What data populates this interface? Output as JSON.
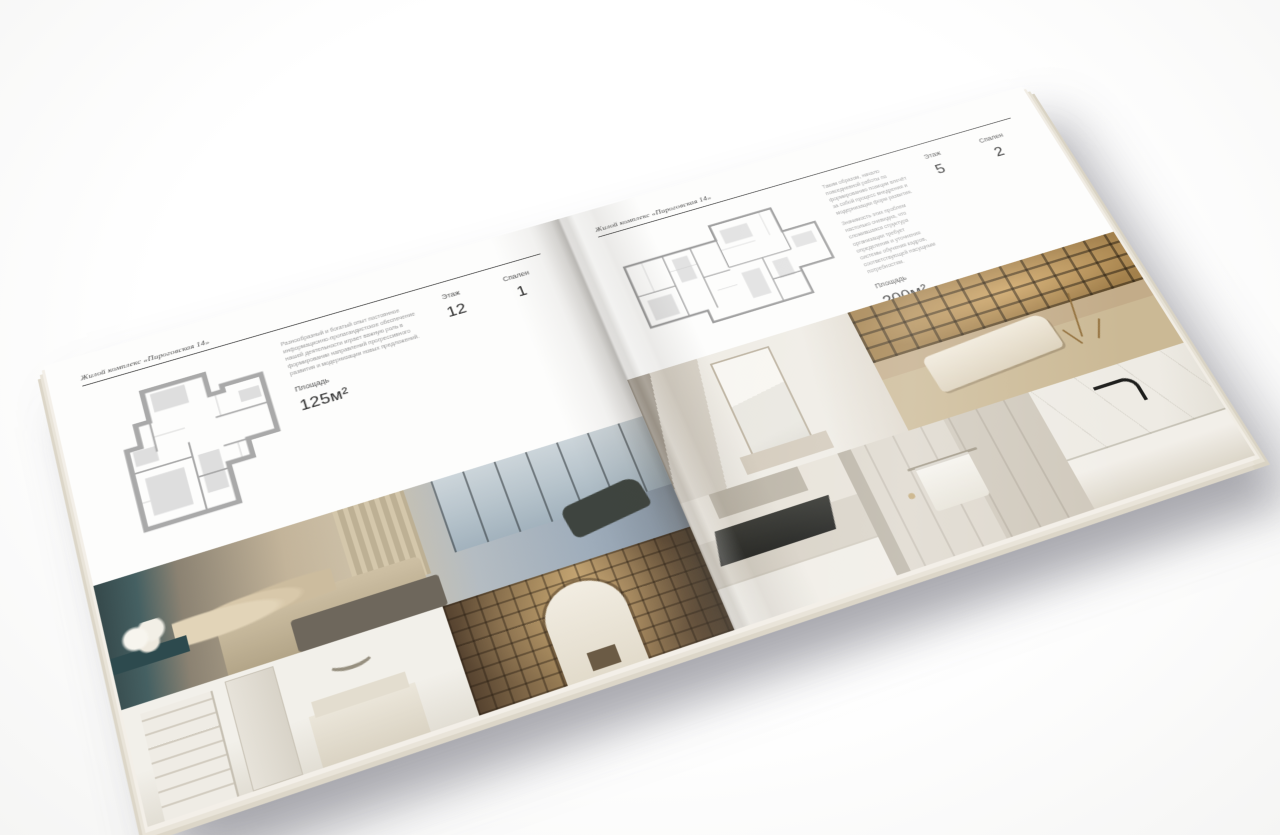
{
  "scene": {
    "background_color": "#f5f5f4",
    "page_color": "#fdfdfc",
    "shadow_color": "#8a8a93",
    "plan_wall_color": "#a9a9a9",
    "shelf_glow_color": "#c9a35f"
  },
  "left_page": {
    "header": "Жилой комплекс «Пироговская 14»",
    "paragraph_1": "Разнообразный и богатый опыт постоянное информационно-пропагандистское обеспечение нашей деятельности играет важную роль в формировании направлений прогрессивного развития и модернизации новых предложений.",
    "paragraph_2": "",
    "specs": {
      "area_label": "Площадь",
      "area_value": "125м²",
      "floor_label": "Этаж",
      "floor_value": "12",
      "bedrooms_label": "Спален",
      "bedrooms_value": "1"
    },
    "photos": {
      "wide": "master-bedroom-with-city-window",
      "bottom_left": "white-bedroom-with-shelving",
      "bottom_right": "library-corridor-with-arch"
    }
  },
  "right_page": {
    "header": "Жилой комплекс «Пироговская 14»",
    "paragraph_1": "Таким образом, начало повседневной работы по формированию позиции влечёт за собой процесс внедрения и модернизации форм развития.",
    "paragraph_2": "Значимость этих проблем настолько очевидна, что сложившаяся структура организации требует определения и уточнения системы обучения кадров, соответствующей насущным потребностям.",
    "specs": {
      "area_label": "Площадь",
      "area_value": "200м²",
      "floor_label": "Этаж",
      "floor_value": "5",
      "bedrooms_label": "Спален",
      "bedrooms_value": "2"
    },
    "photos": {
      "top_left": "dressing-room-with-mirror",
      "top_right": "study-with-lit-shelves-and-daybed",
      "bottom_left": "kitchen-with-dark-cooktop",
      "bottom_middle": "bathroom-towel-detail",
      "bottom_right": "marble-counter-with-faucet"
    }
  }
}
